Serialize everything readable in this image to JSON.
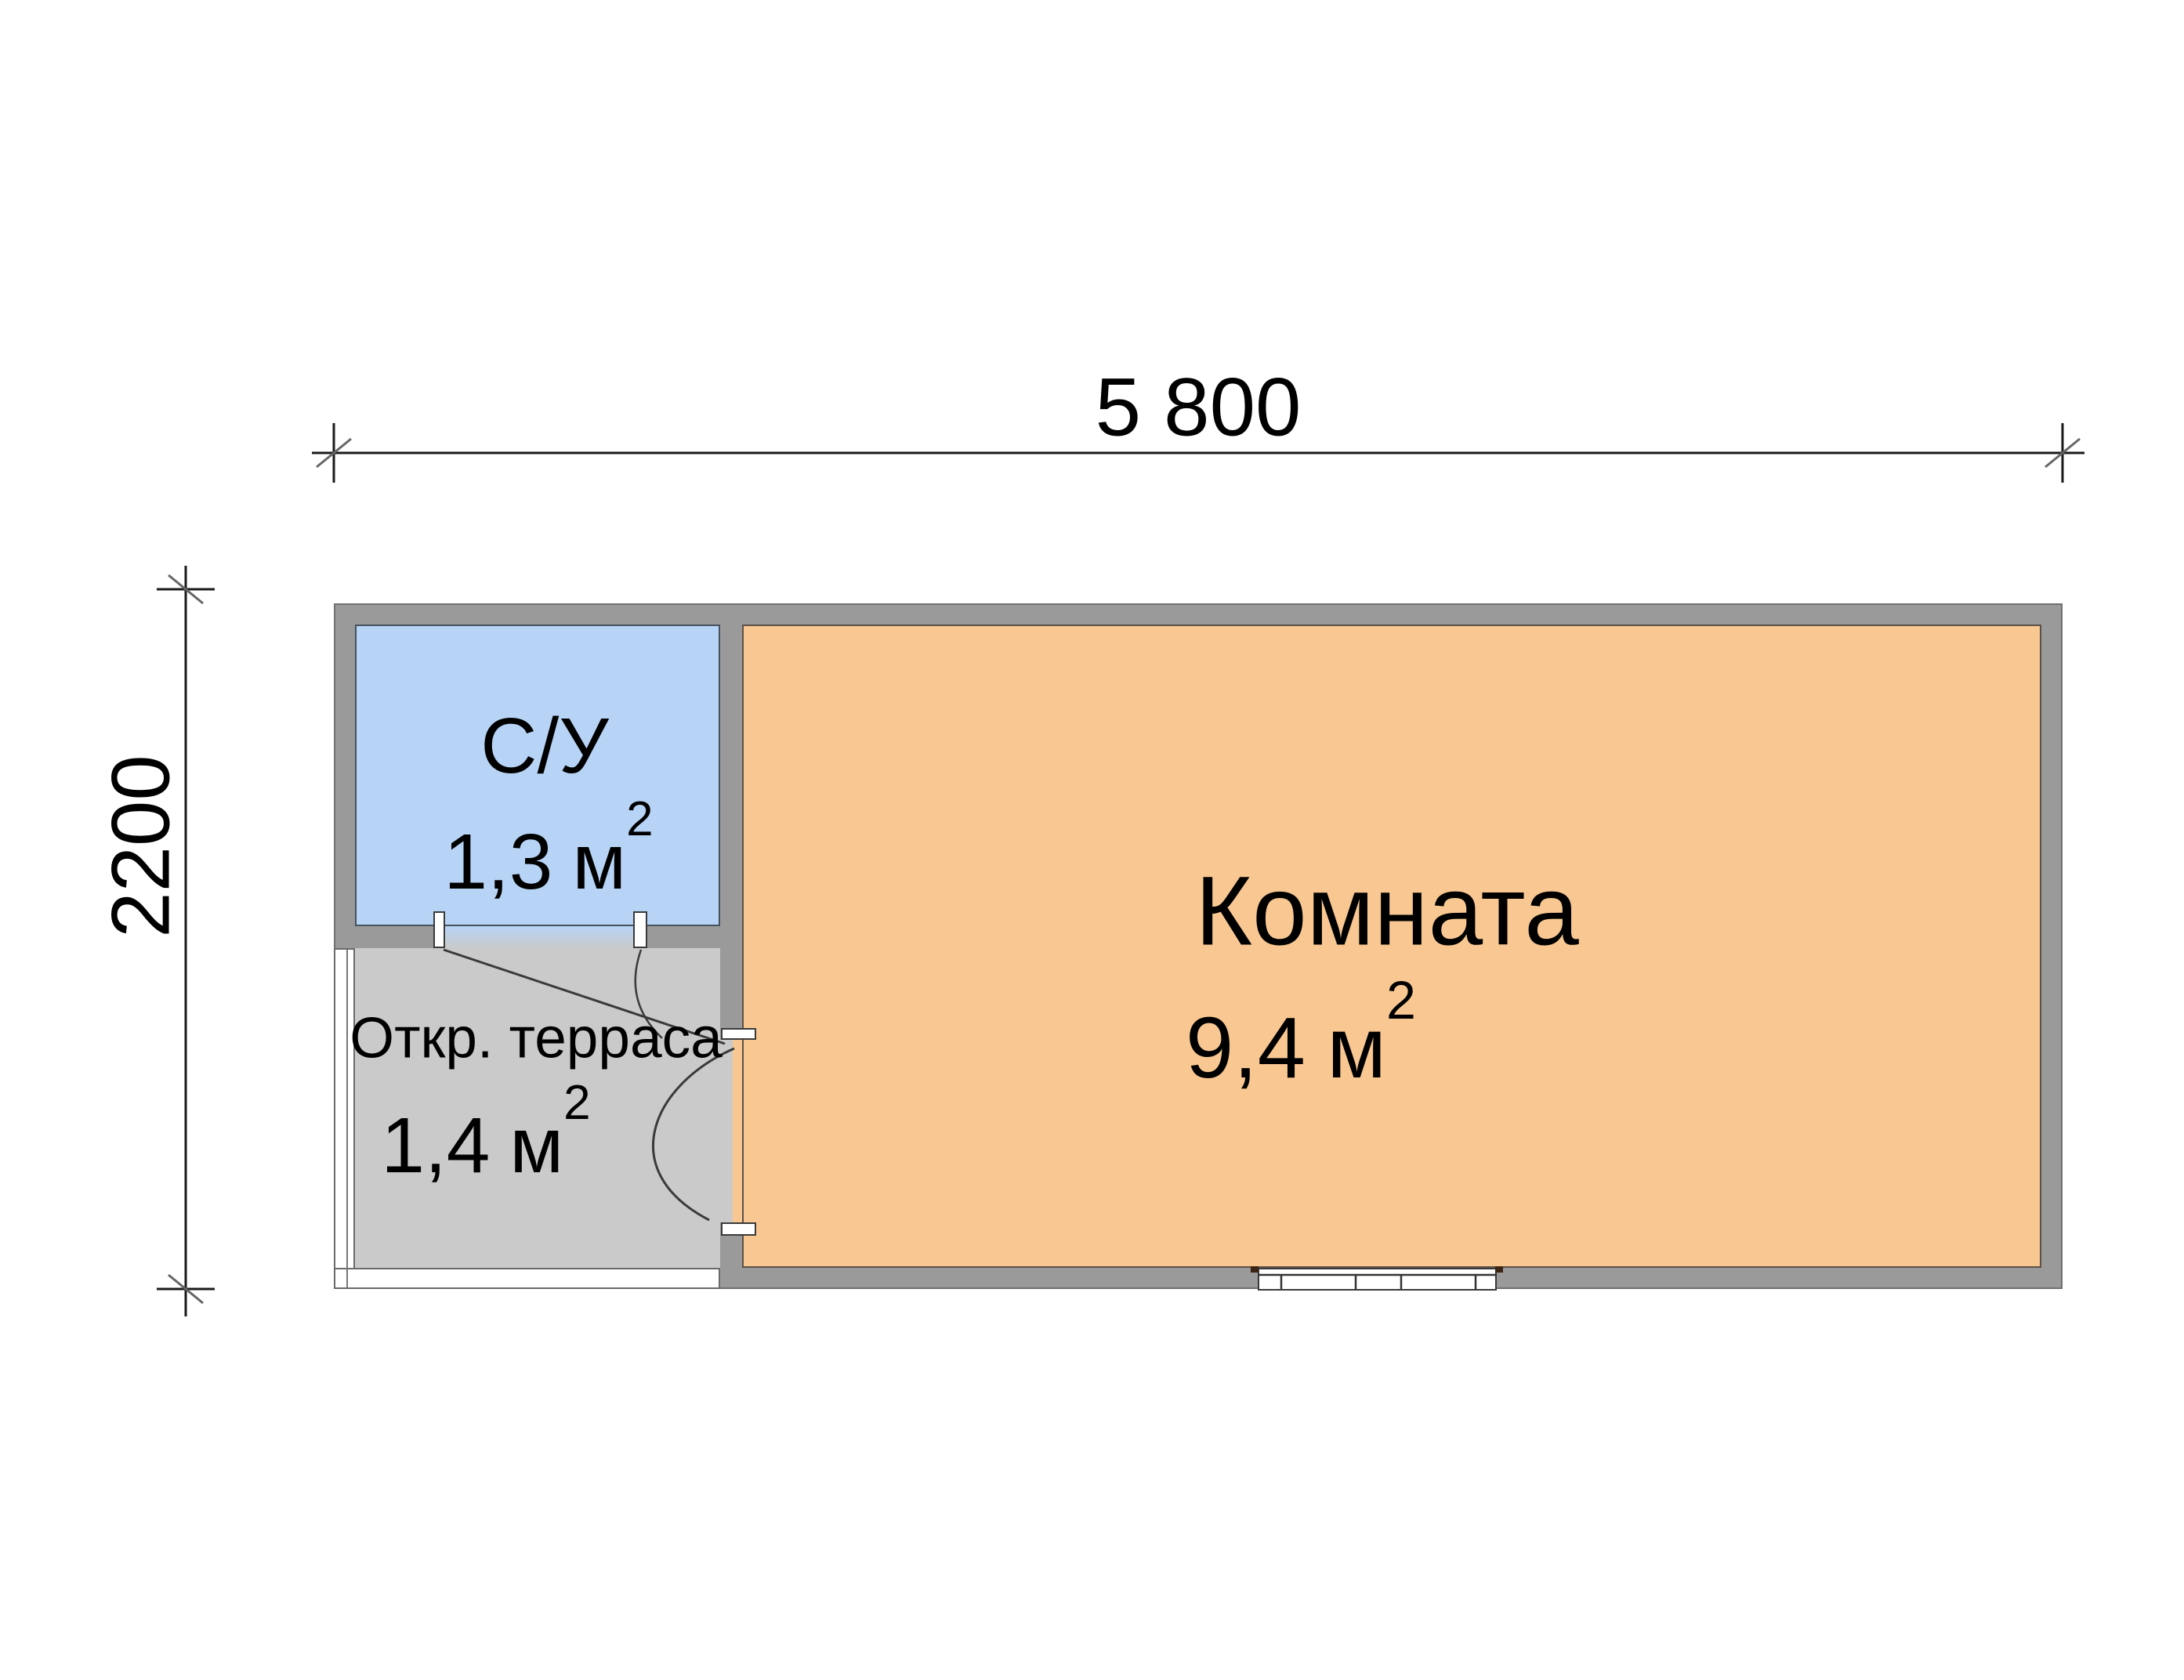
{
  "title": "Floor plan of a cabin with room, bathroom and open terrace",
  "dimensions": {
    "width_label": "5 800",
    "height_label": "2200"
  },
  "rooms": {
    "bathroom": {
      "label": "С/У",
      "area_value": "1,3",
      "area_unit": "м",
      "area_sup": "2"
    },
    "terrace": {
      "label": "Откр. терраса",
      "area_value": "1,4",
      "area_unit": "м",
      "area_sup": "2"
    },
    "main_room": {
      "label": "Комната",
      "area_value": "9,4",
      "area_unit": "м",
      "area_sup": "2"
    }
  },
  "colors": {
    "wall": "#9a9a9a",
    "bathroom_fill": "#b7d4f6",
    "terrace_fill": "#cacaca",
    "main_room_fill": "#f9c892",
    "open_edge_fill": "#ffffff",
    "line": "#1a1a1a",
    "text": "#000000"
  }
}
